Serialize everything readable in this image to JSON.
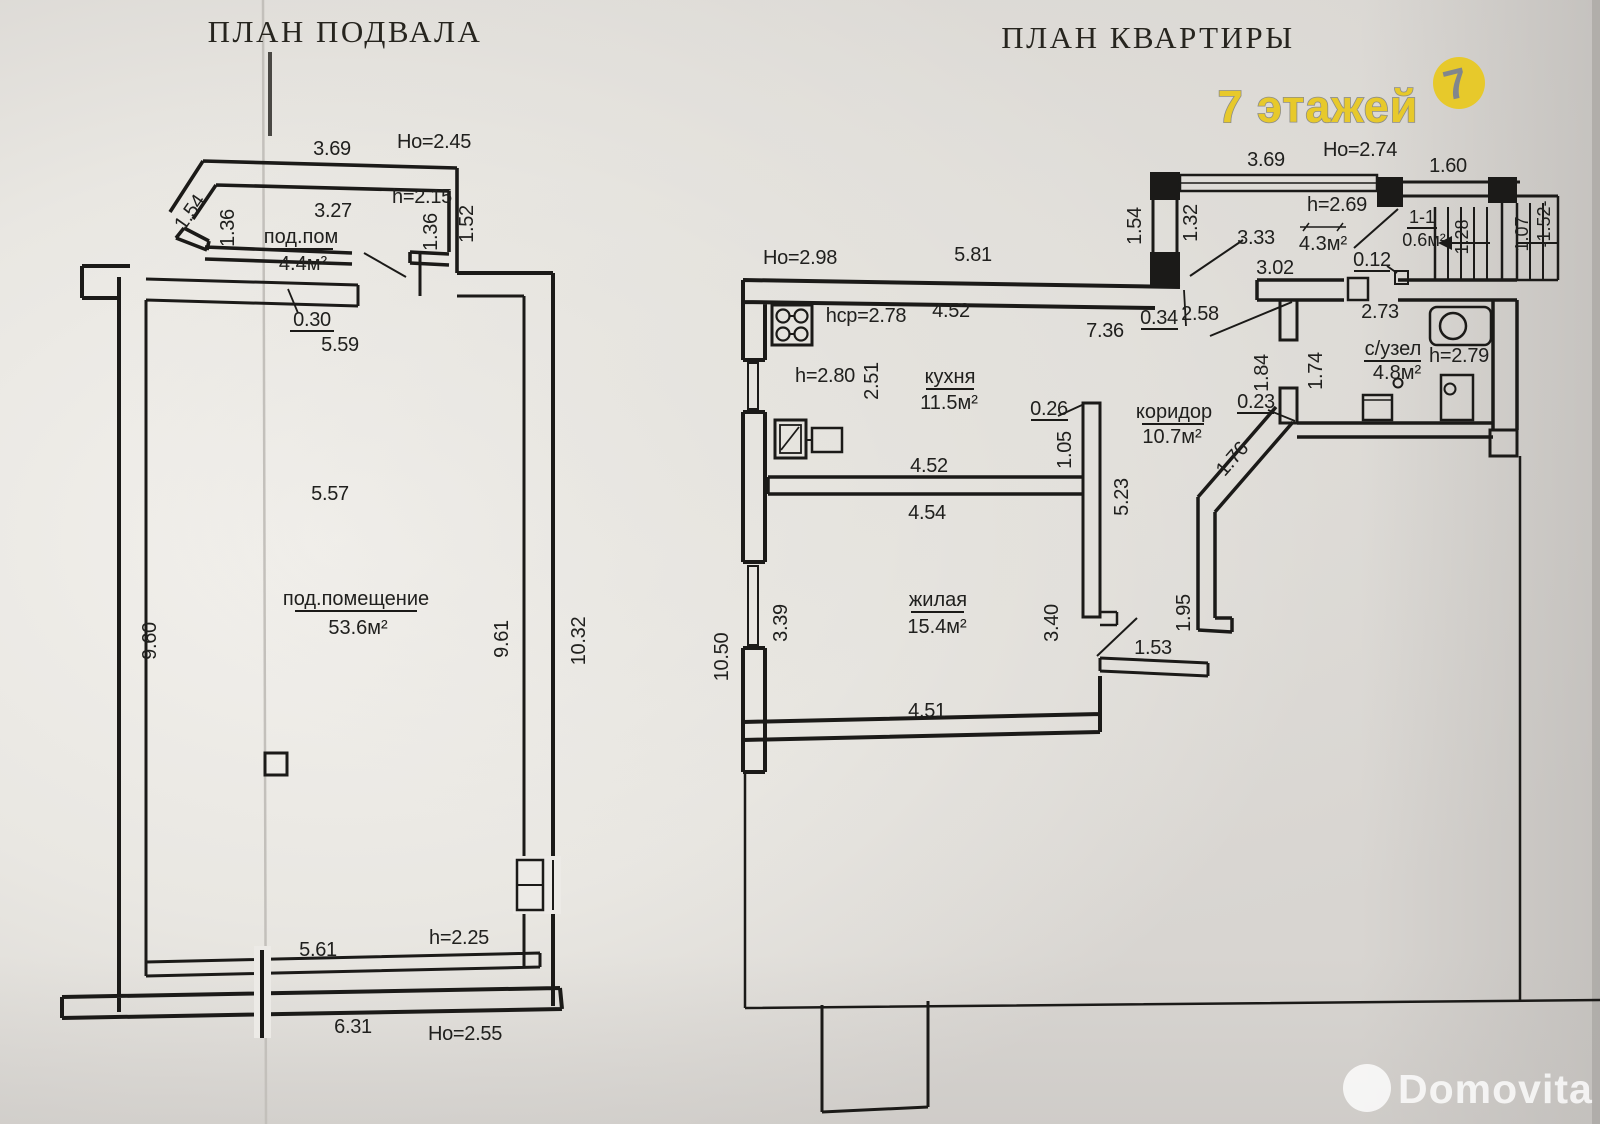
{
  "colors": {
    "ink": "#1b1a18",
    "paper": "#d9d6d2",
    "watermark_yellow": "#e7c92b",
    "watermark_gray": "#81868d",
    "brand_white": "#ffffff"
  },
  "basement": {
    "title": "ПЛАН ПОДВАЛА",
    "rooms": {
      "small_name": "под.пом",
      "small_area": "4.4м²",
      "main_name": "под.помещение",
      "main_area": "53.6м²"
    },
    "labels": {
      "w369": "3.69",
      "ho245": "Но=2.45",
      "w327": "3.27",
      "h215": "h=2.15",
      "d154": "1.54",
      "d136l": "1.36",
      "d136r": "1.36",
      "d152": "1.52",
      "d030": "0.30",
      "d559": "5.59",
      "d557": "5.57",
      "d960": "9.60",
      "d961": "9.61",
      "d1032": "10.32",
      "h225": "h=2.25",
      "d561": "5.61",
      "d631": "6.31",
      "ho255": "Но=2.55"
    }
  },
  "apartment": {
    "title": "ПЛАН КВАРТИРЫ",
    "rooms": {
      "tambour_area": "4.3м²",
      "stair_mark": "1-1",
      "stair_area": "0.6м²",
      "kitchen_name": "кухня",
      "kitchen_area": "11.5м²",
      "hall_name": "коридор",
      "hall_area": "10.7м²",
      "wc_name": "с/узел",
      "wc_area": "4.8м²",
      "living_name": "жилая",
      "living_area": "15.4м²"
    },
    "labels": {
      "w369": "3.69",
      "ho274": "Но=2.74",
      "d160": "1.60",
      "h269": "h=2.69",
      "d154": "1.54",
      "d132": "1.32",
      "d333": "3.33",
      "d128": "1.28",
      "d107": "1.07",
      "d152": "-1.52-",
      "d302": "3.02",
      "d012": "0.12",
      "ho298": "Но=2.98",
      "d581": "5.81",
      "hcp": "hcp=2.78",
      "d452a": "4.52",
      "d736": "7.36",
      "d034": "0.34",
      "d258": "2.58",
      "h280": "h=2.80",
      "d251": "2.51",
      "d026": "0.26",
      "d105": "1.05",
      "d273": "2.73",
      "h279": "h=2.79",
      "d184": "1.84",
      "d174": "1.74",
      "d023": "0.23",
      "d452b": "4.52",
      "d454": "4.54",
      "d523": "5.23",
      "d176": "1.76",
      "d339": "3.39",
      "d340": "3.40",
      "d1050": "10.50",
      "d195": "1.95",
      "d153": "1.53",
      "d451": "4.51"
    }
  },
  "watermark": {
    "text": "7 этажей",
    "badge": "7"
  },
  "brand": {
    "name": "Domovita"
  }
}
